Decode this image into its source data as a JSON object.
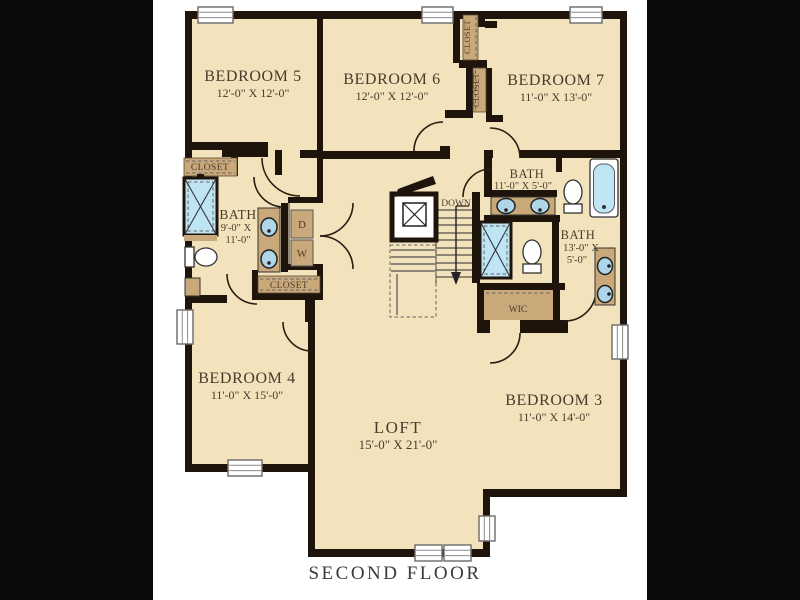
{
  "caption": "SECOND FLOOR",
  "rooms": {
    "bedroom5": {
      "name": "BEDROOM 5",
      "size": "12'-0\" X 12'-0\""
    },
    "bedroom6": {
      "name": "BEDROOM 6",
      "size": "12'-0\" X 12'-0\""
    },
    "bedroom7": {
      "name": "BEDROOM 7",
      "size": "11'-0\" X 13'-0\""
    },
    "bedroom4": {
      "name": "BEDROOM 4",
      "size": "11'-0\" X 15'-0\""
    },
    "bedroom3": {
      "name": "BEDROOM 3",
      "size": "11'-0\" X 14'-0\""
    },
    "loft": {
      "name": "LOFT",
      "size": "15'-0\" X 21'-0\""
    },
    "bath_left": {
      "name": "BATH",
      "size_line1": "9'-0\" X",
      "size_line2": "11'-0\""
    },
    "bath_top": {
      "name": "BATH",
      "size": "11'-0\" X 5'-0\""
    },
    "bath_right": {
      "name": "BATH",
      "size_line1": "13'-0\" X",
      "size_line2": "5'-0\""
    },
    "wic": {
      "name": "WIC"
    }
  },
  "labels": {
    "closet": "CLOSET",
    "down": "DOWN",
    "dryer": "D",
    "washer": "W"
  },
  "colors": {
    "background": "#0b0b0b",
    "sheet": "#ffffff",
    "floor": "#f2e3bd",
    "wall": "#1e140b",
    "closet_fill": "#c9a87a",
    "water_blue": "#bfe4f2",
    "label_text": "#4a3b2c",
    "caption_text": "#3a3a3a"
  }
}
